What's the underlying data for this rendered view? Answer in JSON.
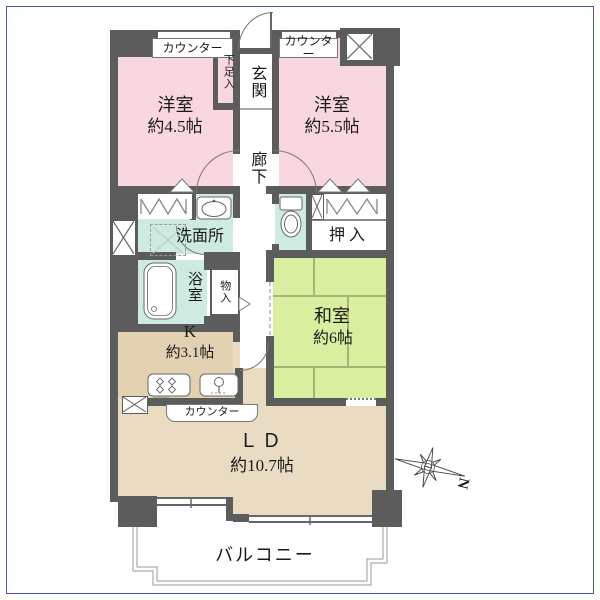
{
  "plan": {
    "rooms": {
      "bedroom_left": {
        "name": "洋室",
        "size": "約4.5帖"
      },
      "bedroom_right": {
        "name": "洋室",
        "size": "約5.5帖"
      },
      "japanese_room": {
        "name": "和室",
        "size": "約6帖"
      },
      "kitchen": {
        "name": "K",
        "size": "約3.1帖"
      },
      "living_dining": {
        "name": "ＬＤ",
        "size": "約10.7帖"
      },
      "entrance": {
        "name": "玄関"
      },
      "corridor": {
        "name": "廊下"
      },
      "washroom": {
        "name": "洗面所"
      },
      "bathroom": {
        "name": "浴室"
      },
      "shoe_cabinet": {
        "name": "下足入"
      },
      "storage": {
        "name": "物入"
      },
      "oshiire_closet": {
        "name": "押入"
      },
      "balcony": {
        "name": "バルコニー"
      }
    },
    "labels": {
      "counter": "カウンター",
      "north": "N"
    },
    "colors": {
      "frame": "#4353b8",
      "wall": "#5c5c5c",
      "bedroom_pink": "#f8d7df",
      "tatami_green": "#d9ee9f",
      "wet_teal": "#cdebe3",
      "living_beige": "#e9dcc2",
      "kitchen_beige": "#e2d2b2"
    }
  }
}
